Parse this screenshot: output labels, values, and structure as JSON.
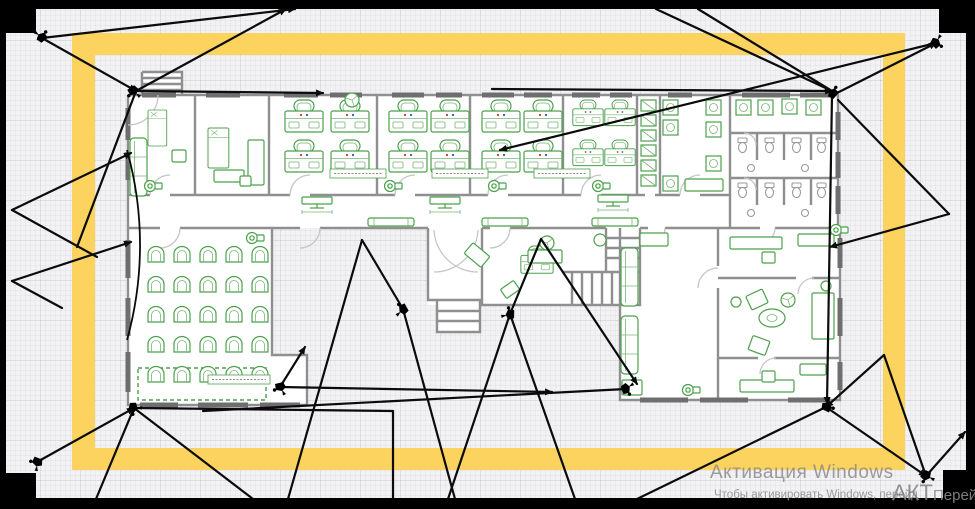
{
  "watermark": {
    "line1": "Активация Windows",
    "line2": "Чтобы активировать Windows, перейд",
    "overlay_big": "АКТ",
    "overlay_med": "Перей"
  },
  "colors": {
    "zone_yellow": "#FBD35E",
    "furniture_green": "#4ba04b",
    "wall_gray": "#8f8f8f",
    "frame_black": "#000000",
    "sightline_black": "#0b0b0b",
    "watermark_gray": "#8a8a8a"
  },
  "scene": {
    "cameras": [
      [
        42,
        37,
        155
      ],
      [
        133,
        91,
        -20
      ],
      [
        936,
        43,
        -120
      ],
      [
        833,
        93,
        145
      ],
      [
        37,
        462,
        35
      ],
      [
        133,
        408,
        -60
      ],
      [
        280,
        387,
        0
      ],
      [
        403,
        309,
        75
      ],
      [
        510,
        314,
        105
      ],
      [
        626,
        389,
        -95
      ],
      [
        827,
        407,
        -140
      ],
      [
        926,
        476,
        -35
      ]
    ],
    "sightlines": [
      [
        42,
        38,
        295,
        9,
        1
      ],
      [
        42,
        38,
        136,
        91,
        1
      ],
      [
        136,
        91,
        286,
        9,
        1
      ],
      [
        136,
        91,
        323,
        93,
        1
      ],
      [
        136,
        91,
        77,
        247,
        0
      ],
      [
        12,
        210,
        131,
        153,
        1
      ],
      [
        12,
        210,
        97,
        257,
        0
      ],
      [
        12,
        281,
        131,
        242,
        1
      ],
      [
        12,
        281,
        62,
        308,
        0
      ],
      [
        37,
        462,
        134,
        408,
        1
      ],
      [
        134,
        408,
        253,
        499,
        0
      ],
      [
        134,
        408,
        393,
        411,
        0
      ],
      [
        393,
        411,
        393,
        499,
        0
      ],
      [
        134,
        408,
        96,
        499,
        0
      ],
      [
        403,
        309,
        362,
        240,
        0
      ],
      [
        362,
        240,
        288,
        499,
        0
      ],
      [
        403,
        309,
        455,
        499,
        0
      ],
      [
        510,
        314,
        541,
        239,
        0
      ],
      [
        541,
        239,
        637,
        384,
        1
      ],
      [
        510,
        314,
        448,
        499,
        0
      ],
      [
        510,
        314,
        575,
        499,
        0
      ],
      [
        280,
        387,
        552,
        392,
        1
      ],
      [
        280,
        387,
        305,
        347,
        1
      ],
      [
        626,
        389,
        203,
        411,
        0
      ],
      [
        826,
        407,
        637,
        499,
        0
      ],
      [
        492,
        89,
        832,
        91,
        1
      ],
      [
        832,
        91,
        656,
        9,
        0
      ],
      [
        832,
        91,
        698,
        9,
        0
      ],
      [
        936,
        43,
        500,
        150,
        1
      ],
      [
        833,
        95,
        936,
        43,
        1
      ],
      [
        832,
        95,
        827,
        404,
        1
      ],
      [
        838,
        100,
        949,
        214,
        0
      ],
      [
        949,
        214,
        830,
        247,
        1
      ],
      [
        826,
        407,
        926,
        476,
        1
      ],
      [
        926,
        476,
        884,
        355,
        0
      ],
      [
        884,
        355,
        826,
        407,
        1
      ],
      [
        926,
        476,
        965,
        432,
        1
      ]
    ]
  },
  "plan": {
    "desks": [
      [
        284,
        100
      ],
      [
        330,
        100
      ],
      [
        284,
        140
      ],
      [
        330,
        140
      ],
      [
        388,
        100
      ],
      [
        430,
        100
      ],
      [
        388,
        140
      ],
      [
        430,
        140
      ],
      [
        481,
        100
      ],
      [
        523,
        100
      ],
      [
        481,
        140
      ],
      [
        523,
        140
      ],
      [
        572,
        100,
        0.8
      ],
      [
        604,
        100,
        0.8
      ],
      [
        572,
        140,
        0.8
      ],
      [
        604,
        140,
        0.8
      ],
      [
        520,
        246,
        0.85
      ]
    ],
    "chairsGrid": {
      "x0": 146,
      "y0": 246,
      "dx": 26,
      "dy": 30,
      "cols": 5,
      "rows": 5
    },
    "sofas": [
      [
        130,
        138
      ],
      [
        621,
        248
      ],
      [
        621,
        316
      ]
    ],
    "beds": [
      [
        148,
        110,
        0.72
      ],
      [
        208,
        128,
        0.8
      ]
    ],
    "toilets": [
      [
        738,
        138
      ],
      [
        765,
        138
      ],
      [
        792,
        138
      ],
      [
        817,
        138
      ],
      [
        738,
        183
      ],
      [
        765,
        183
      ],
      [
        792,
        183
      ],
      [
        817,
        183
      ]
    ],
    "sinks": [
      [
        751,
        168
      ],
      [
        805,
        168
      ],
      [
        751,
        213
      ],
      [
        805,
        213
      ]
    ],
    "lockers": {
      "x": 641,
      "y0": 100,
      "n": 6,
      "dy": 15
    },
    "appliances": [
      [
        663,
        100
      ],
      [
        663,
        120
      ],
      [
        706,
        100
      ],
      [
        706,
        122
      ],
      [
        706,
        156
      ],
      [
        663,
        176
      ],
      [
        736,
        100
      ],
      [
        758,
        100
      ],
      [
        782,
        99
      ],
      [
        806,
        100
      ]
    ],
    "benches": [
      [
        482,
        218
      ],
      [
        592,
        218
      ],
      [
        368,
        218
      ]
    ],
    "lecterns": [
      [
        302,
        197
      ],
      [
        430,
        197
      ],
      [
        598,
        195
      ]
    ],
    "fans": [
      [
        352,
        100
      ],
      [
        547,
        243
      ],
      [
        788,
        300
      ]
    ],
    "printers": [
      [
        150,
        186
      ],
      [
        390,
        186
      ],
      [
        494,
        186
      ],
      [
        598,
        186
      ],
      [
        252,
        238
      ],
      [
        688,
        390
      ],
      [
        836,
        230
      ]
    ],
    "tables": [
      [
        772,
        318
      ]
    ],
    "miscRects": [
      [
        172,
        150,
        14,
        12
      ],
      [
        214,
        170,
        30,
        12
      ],
      [
        248,
        140,
        16,
        45
      ],
      [
        240,
        176,
        11,
        10
      ],
      [
        640,
        233,
        28,
        13
      ],
      [
        622,
        380,
        20,
        15
      ],
      [
        730,
        237,
        52,
        12
      ],
      [
        798,
        234,
        36,
        12
      ],
      [
        762,
        252,
        13,
        11
      ],
      [
        812,
        293,
        22,
        46
      ],
      [
        740,
        380,
        54,
        12
      ],
      [
        800,
        364,
        26,
        11
      ],
      [
        762,
        371,
        13,
        11
      ],
      [
        685,
        179,
        38,
        12
      ],
      [
        528,
        250,
        34,
        13
      ]
    ],
    "rotRects": [
      [
        748,
        292,
        18,
        15,
        -25
      ],
      [
        750,
        338,
        18,
        15,
        20
      ],
      [
        466,
        248,
        22,
        14,
        40
      ],
      [
        502,
        284,
        16,
        11,
        -35
      ]
    ],
    "miscCircles": [
      [
        826,
        286,
        5
      ],
      [
        736,
        302,
        5
      ],
      [
        600,
        240,
        6
      ]
    ],
    "labels": [
      [
        330,
        169,
        56
      ],
      [
        432,
        169,
        56
      ],
      [
        534,
        169,
        56
      ],
      [
        208,
        375,
        62
      ]
    ]
  }
}
